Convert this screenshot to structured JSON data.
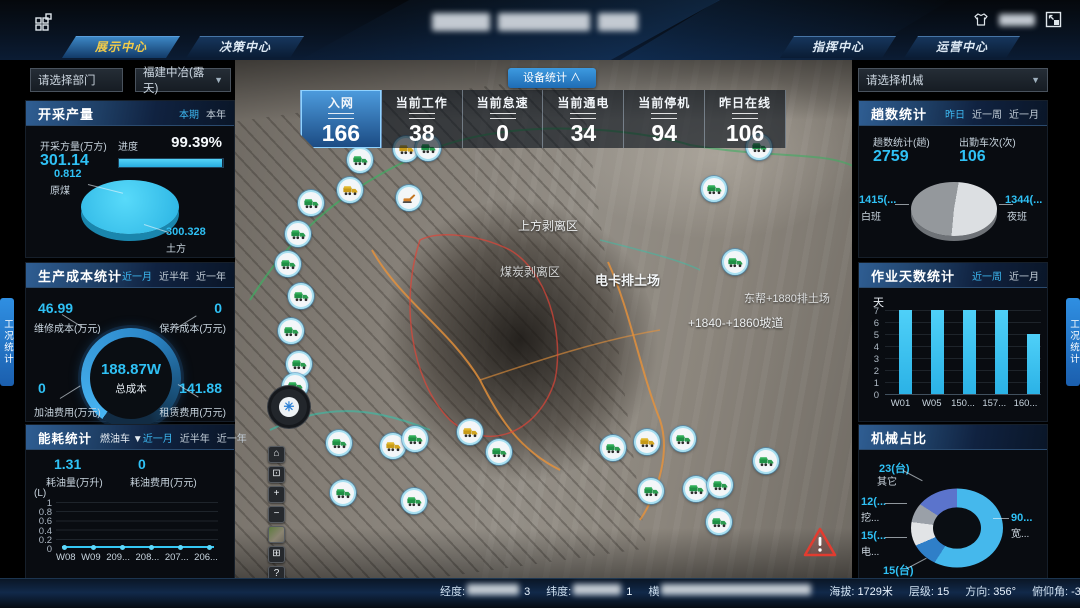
{
  "accent_color": "#2fc1f5",
  "header": {
    "nav_tabs": [
      {
        "label": "展示中心",
        "active": true
      },
      {
        "label": "决策中心",
        "active": false
      },
      {
        "label": "指挥中心",
        "active": false
      },
      {
        "label": "运营中心",
        "active": false
      }
    ],
    "title_redacted": true,
    "user_redacted": true
  },
  "filters": {
    "department_placeholder": "请选择部门",
    "org_selected": "福建中冶(露天)",
    "machine_placeholder": "请选择机械"
  },
  "device_stats": {
    "toggle_label": "设备统计 ∧",
    "items": [
      {
        "label": "入网",
        "value": "166",
        "active": true
      },
      {
        "label": "当前工作",
        "value": "38",
        "active": false
      },
      {
        "label": "当前怠速",
        "value": "0",
        "active": false
      },
      {
        "label": "当前通电",
        "value": "34",
        "active": false
      },
      {
        "label": "当前停机",
        "value": "94",
        "active": false
      },
      {
        "label": "昨日在线",
        "value": "106",
        "active": false
      }
    ]
  },
  "panels": {
    "production": {
      "title": "开采产量",
      "tabs": [
        {
          "label": "本期",
          "active": true
        },
        {
          "label": "本年",
          "active": false
        }
      ],
      "volume_label": "开采方量(万方)",
      "volume_value": "301.14",
      "progress_label": "进度",
      "progress_value": "99.39%",
      "progress_pct": 99.39,
      "chart": {
        "type": "pie",
        "slices": [
          {
            "label": "原煤",
            "value": 0.812,
            "value_label": "0.812"
          },
          {
            "label": "土方",
            "value": 300.328,
            "value_label": "300.328"
          }
        ],
        "color": "#35c8f0"
      }
    },
    "cost": {
      "title": "生产成本统计",
      "tabs": [
        {
          "label": "近一月",
          "active": true
        },
        {
          "label": "近半年",
          "active": false
        },
        {
          "label": "近一年",
          "active": false
        }
      ],
      "center_value": "188.87W",
      "center_label": "总成本",
      "corners": [
        {
          "value": "46.99",
          "label": "维修成本(万元)"
        },
        {
          "value": "0",
          "label": "保养成本(万元)"
        },
        {
          "value": "0",
          "label": "加油费用(万元)"
        },
        {
          "value": "141.88",
          "label": "租赁费用(万元)"
        }
      ]
    },
    "energy": {
      "title": "能耗统计",
      "vehicle_dropdown": "燃油车 ▼",
      "tabs": [
        {
          "label": "近一月",
          "active": true
        },
        {
          "label": "近半年",
          "active": false
        },
        {
          "label": "近一年",
          "active": false
        }
      ],
      "metric1_value": "1.31",
      "metric1_label": "耗油量(万升)",
      "metric2_value": "0",
      "metric2_label": "耗油费用(万元)",
      "chart": {
        "type": "line",
        "unit": "(L)",
        "y_ticks": [
          "1",
          "0.8",
          "0.6",
          "0.4",
          "0.2",
          "0"
        ],
        "categories": [
          "W08",
          "W09",
          "209...",
          "208...",
          "207...",
          "206..."
        ],
        "values": [
          0,
          0,
          0,
          0,
          0,
          0
        ],
        "ylim": [
          0,
          1
        ]
      }
    },
    "trips": {
      "title": "趟数统计",
      "tabs": [
        {
          "label": "昨日",
          "active": true
        },
        {
          "label": "近一周",
          "active": false
        },
        {
          "label": "近一月",
          "active": false
        }
      ],
      "metric1_label": "趟数统计(趟)",
      "metric1_value": "2759",
      "metric2_label": "出勤车次(次)",
      "metric2_value": "106",
      "chart": {
        "type": "pie",
        "slices": [
          {
            "label": "白班",
            "value": 1415,
            "value_label": "1415(...",
            "color": "#94989c"
          },
          {
            "label": "夜班",
            "value": 1344,
            "value_label": "1344(...",
            "color": "#dcdfe2"
          }
        ]
      }
    },
    "workdays": {
      "title": "作业天数统计",
      "tabs": [
        {
          "label": "近一周",
          "active": true
        },
        {
          "label": "近一月",
          "active": false
        }
      ],
      "chart": {
        "type": "bar",
        "unit": "天",
        "y_ticks": [
          "7",
          "6",
          "5",
          "4",
          "3",
          "2",
          "1",
          "0"
        ],
        "categories": [
          "W01",
          "W05",
          "150...",
          "157...",
          "160..."
        ],
        "values": [
          7,
          7,
          7,
          7,
          5
        ],
        "ylim": [
          0,
          7
        ]
      }
    },
    "machinery": {
      "title": "机械占比",
      "chart": {
        "type": "donut",
        "slices": [
          {
            "label": "宽...",
            "value_label": "90...",
            "value": 90,
            "color": "#45b8ec"
          },
          {
            "label": "矿卡",
            "value_label": "15(台)",
            "value": 15,
            "color": "#2f7fc8"
          },
          {
            "label": "电...",
            "value_label": "15(...",
            "value": 15,
            "color": "#e2e4e6"
          },
          {
            "label": "挖...",
            "value_label": "12(...",
            "value": 12,
            "color": "#9aa0a8"
          },
          {
            "label": "其它",
            "value_label": "23(台)",
            "value": 23,
            "color": "#5b74cc"
          }
        ]
      }
    }
  },
  "map": {
    "labels": [
      {
        "text": "上方剥离区",
        "x": 518,
        "y": 217,
        "size": 12,
        "bold": false,
        "opacity": 0.95
      },
      {
        "text": "煤炭剥离区",
        "x": 500,
        "y": 263,
        "size": 12,
        "bold": false,
        "opacity": 0.8
      },
      {
        "text": "电卡排土场",
        "x": 595,
        "y": 270,
        "size": 13,
        "bold": true,
        "opacity": 1
      },
      {
        "text": "东帮+1880排土场",
        "x": 744,
        "y": 290,
        "size": 11,
        "bold": false,
        "opacity": 0.85
      },
      {
        "text": "+1840-+1860坡道",
        "x": 688,
        "y": 314,
        "size": 12,
        "bold": false,
        "opacity": 0.95
      }
    ],
    "tools": [
      {
        "name": "home-tool",
        "glyph": "⌂"
      },
      {
        "name": "extent-tool",
        "glyph": "⊡"
      },
      {
        "name": "zoom-in-tool",
        "glyph": "+"
      },
      {
        "name": "zoom-out-tool",
        "glyph": "−"
      },
      {
        "name": "basemap-tool",
        "glyph": ""
      },
      {
        "name": "split-view-tool",
        "glyph": "⊞"
      },
      {
        "name": "help-tool",
        "glyph": "?"
      },
      {
        "name": "more-tool",
        "glyph": "≣"
      }
    ],
    "markers": [
      {
        "x": 404,
        "y": 147,
        "t": "y"
      },
      {
        "x": 426,
        "y": 146,
        "t": "g"
      },
      {
        "x": 358,
        "y": 158,
        "t": "g"
      },
      {
        "x": 348,
        "y": 188,
        "t": "y"
      },
      {
        "x": 309,
        "y": 201,
        "t": "g"
      },
      {
        "x": 296,
        "y": 232,
        "t": "g"
      },
      {
        "x": 286,
        "y": 262,
        "t": "g"
      },
      {
        "x": 299,
        "y": 294,
        "t": "g"
      },
      {
        "x": 289,
        "y": 329,
        "t": "g"
      },
      {
        "x": 297,
        "y": 362,
        "t": "g"
      },
      {
        "x": 293,
        "y": 384,
        "t": "g"
      },
      {
        "x": 407,
        "y": 196,
        "t": "e"
      },
      {
        "x": 757,
        "y": 145,
        "t": "g"
      },
      {
        "x": 712,
        "y": 187,
        "t": "g"
      },
      {
        "x": 733,
        "y": 260,
        "t": "g"
      },
      {
        "x": 337,
        "y": 441,
        "t": "g"
      },
      {
        "x": 391,
        "y": 444,
        "t": "y"
      },
      {
        "x": 413,
        "y": 437,
        "t": "g"
      },
      {
        "x": 468,
        "y": 430,
        "t": "y"
      },
      {
        "x": 497,
        "y": 450,
        "t": "g"
      },
      {
        "x": 341,
        "y": 491,
        "t": "g"
      },
      {
        "x": 412,
        "y": 499,
        "t": "g"
      },
      {
        "x": 611,
        "y": 446,
        "t": "g"
      },
      {
        "x": 645,
        "y": 440,
        "t": "y"
      },
      {
        "x": 681,
        "y": 437,
        "t": "g"
      },
      {
        "x": 649,
        "y": 489,
        "t": "g"
      },
      {
        "x": 694,
        "y": 487,
        "t": "g"
      },
      {
        "x": 718,
        "y": 483,
        "t": "g"
      },
      {
        "x": 764,
        "y": 459,
        "t": "g"
      },
      {
        "x": 717,
        "y": 520,
        "t": "g"
      }
    ]
  },
  "side_tabs": {
    "left": "工况统计",
    "right": "工况统计"
  },
  "status_bar": {
    "items": [
      {
        "label": "经度:",
        "redacted": true,
        "suffix": "3"
      },
      {
        "label": "纬度:",
        "redacted": true,
        "suffix": "1"
      },
      {
        "label": "横",
        "redacted": true,
        "suffix": ""
      },
      {
        "label": "海拔:",
        "value": "1729米"
      },
      {
        "label": "层级:",
        "value": "15"
      },
      {
        "label": "方向:",
        "value": "356°"
      },
      {
        "label": "俯仰角:",
        "value": "-37°"
      },
      {
        "label": "视高:",
        "value": "2926.5米"
      }
    ]
  }
}
